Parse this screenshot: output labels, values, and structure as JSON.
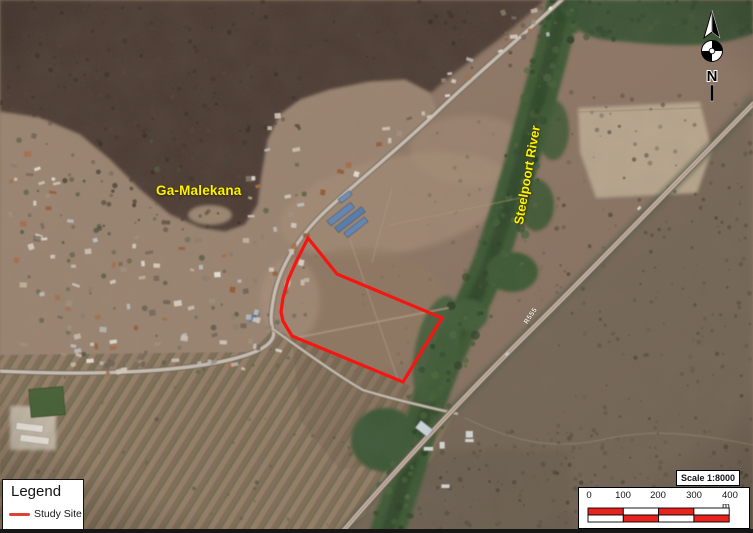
{
  "map_labels": {
    "settlement": "Ga-Malekana",
    "river": "Steelpoort River",
    "road": "R555"
  },
  "study_site": {
    "points": "308,238 337,274 442,318 403,382 292,336 283,321 281,312 283,298 288,280 296,262",
    "color": "#f61510"
  },
  "legend": {
    "title": "Legend",
    "items": [
      {
        "label": "Study Site",
        "color": "#e04038"
      }
    ]
  },
  "scale_bar": {
    "title": "Scale 1:8000",
    "ticks": [
      "0",
      "100",
      "200",
      "300",
      "400 m"
    ],
    "red": "#e8231e",
    "white": "#ffffff"
  },
  "compass": {
    "label": "N"
  }
}
